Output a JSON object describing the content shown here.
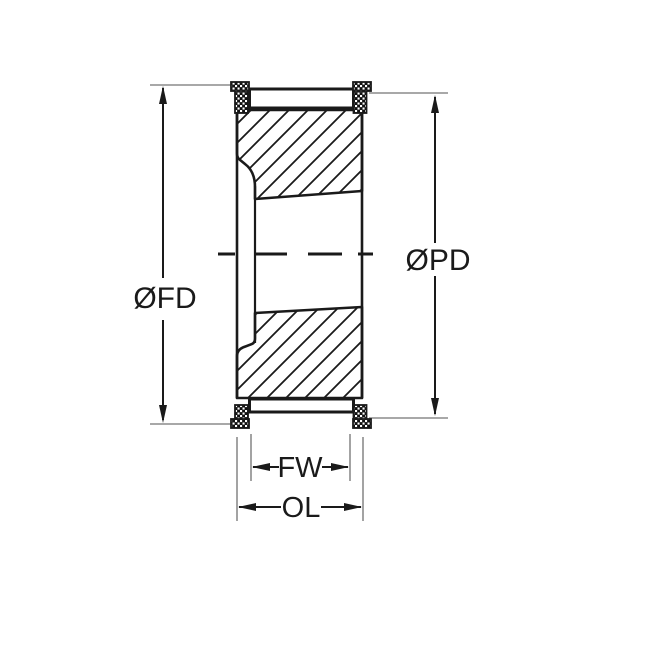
{
  "drawing": {
    "type": "pulley-cross-section",
    "labels": {
      "flange_diameter": "ØFD",
      "pitch_diameter": "ØPD",
      "face_width": "FW",
      "overall_length": "OL"
    }
  },
  "colors": {
    "line": "#1a1a1a",
    "extension_line": "#8c8c8c",
    "background": "#ffffff"
  }
}
